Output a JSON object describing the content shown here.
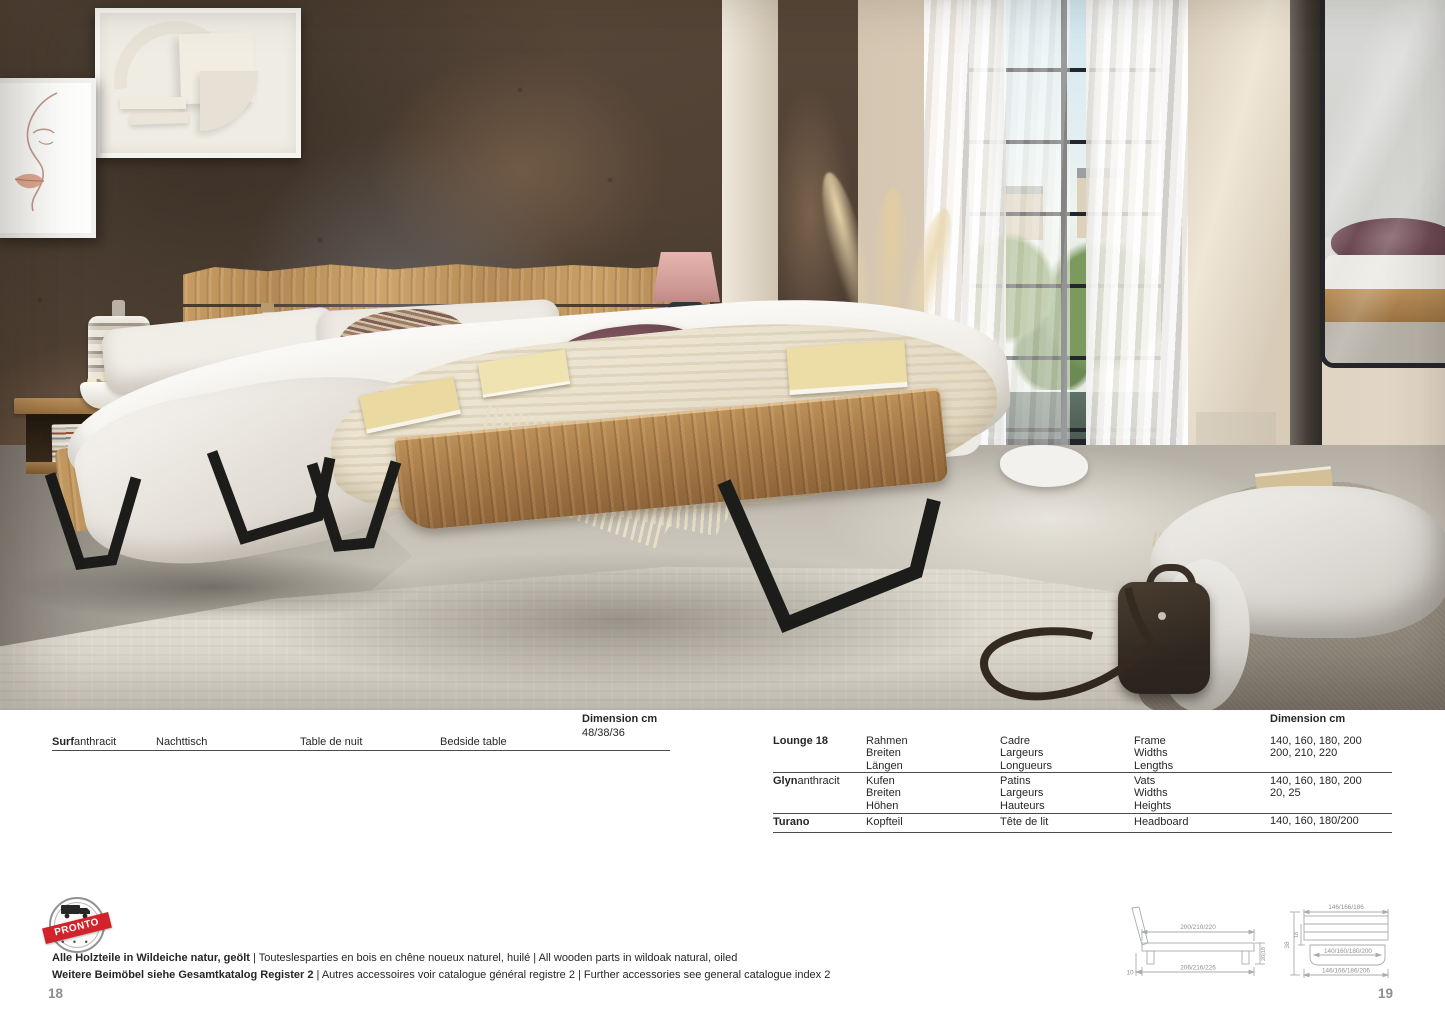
{
  "surf_table": {
    "dimension_header": "Dimension cm",
    "dimension_value": "48/38/36",
    "row": {
      "name_bold": "Surf",
      "name_rest": "anthracit",
      "de": "Nachttisch",
      "fr": "Table de nuit",
      "en": "Bedside table"
    }
  },
  "bed_table": {
    "dimension_header": "Dimension cm",
    "rows": [
      {
        "name_bold": "Lounge 18",
        "name_rest": "",
        "de": [
          "Rahmen",
          "Breiten",
          "Längen"
        ],
        "fr": [
          "Cadre",
          "Largeurs",
          "Longueurs"
        ],
        "en": [
          "Frame",
          "Widths",
          "Lengths"
        ],
        "dims": [
          "",
          "140, 160, 180, 200",
          "200, 210, 220"
        ]
      },
      {
        "name_bold": "Glyn",
        "name_rest": "anthracit",
        "de": [
          "Kufen",
          "Breiten",
          "Höhen"
        ],
        "fr": [
          "Patins",
          "Largeurs",
          "Hauteurs"
        ],
        "en": [
          "Vats",
          "Widths",
          "Heights"
        ],
        "dims": [
          "",
          "140, 160, 180, 200",
          "20, 25"
        ]
      },
      {
        "name_bold": "Turano",
        "name_rest": "",
        "de": [
          "Kopfteil"
        ],
        "fr": [
          "Tête de lit"
        ],
        "en": [
          "Headboard"
        ],
        "dims": [
          "140, 160, 180/200"
        ]
      }
    ]
  },
  "stamp": {
    "label": "PRONTO"
  },
  "notes": [
    {
      "bold": "Alle Holzteile in Wildeiche natur, geölt",
      "rest": " | Touteslesparties en bois en chêne noueux naturel, huilé | All wooden parts in wildoak natural, oiled"
    },
    {
      "bold": "Weitere Beimöbel siehe Gesamtkatalog Register 2",
      "rest": " | Autres accessoires voir catalogue général registre 2 | Further accessories see general catalogue index 2"
    }
  ],
  "drawings": {
    "side": {
      "top": "200/210/220",
      "bottom": "206/216/226",
      "height": "20|18",
      "offset": "10"
    },
    "front": {
      "top": "146/166/186",
      "inner": "140/160/180/200",
      "bottom": "146/166/186/206",
      "height": "38",
      "inner_height": "18"
    }
  },
  "pages": {
    "left": "18",
    "right": "19"
  },
  "colors": {
    "stamp_red": "#d2232a",
    "text": "#262624",
    "page_number": "#8e8e8c",
    "drawing_line": "#a7adab"
  }
}
